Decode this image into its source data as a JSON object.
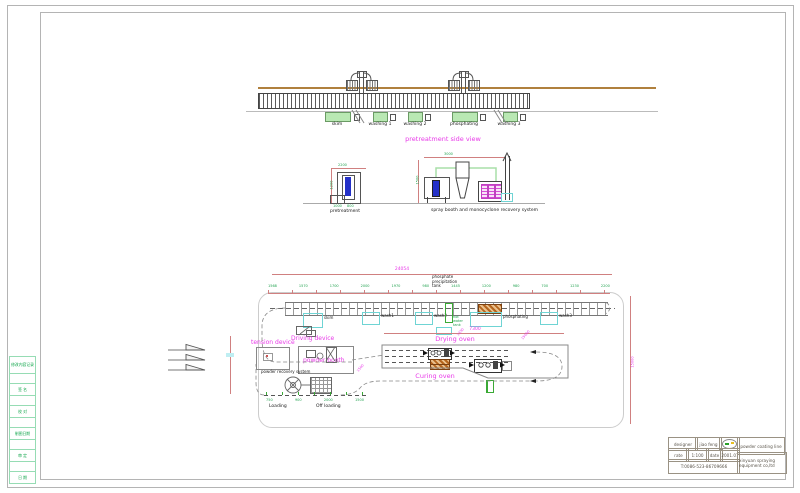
{
  "left_strip": {
    "cells": [
      "修改内容记录",
      "",
      "签 名",
      "",
      "校 对",
      "",
      "制图日期",
      "",
      "审 定",
      "",
      "日 期"
    ]
  },
  "side_view": {
    "title": "pretreatment side view",
    "tanks": [
      "skim",
      "washing 1",
      "washing 2",
      "phosphating",
      "washing 3"
    ]
  },
  "elevation": {
    "pretreatment_label": "pretreatment",
    "spray_label": "spray booth and monocyclone recovery system",
    "dims_green": [
      "2200",
      "1200",
      "3000",
      "1500",
      "1000",
      "800"
    ]
  },
  "plan": {
    "dim_total": "24054",
    "dim_row": [
      "1568",
      "1570",
      "1700",
      "2000",
      "1970",
      "980",
      "1445",
      "1200",
      "980",
      "700",
      "1230",
      "2200"
    ],
    "phosphate_tank": [
      "phosphate",
      "precipitation",
      "tank"
    ],
    "tanks": {
      "skim": "skim",
      "wash1": "wash1",
      "wash2": "wash2",
      "phosphating": "phosphating",
      "wash3": "wash3"
    },
    "hot_water": [
      "hot",
      "water",
      "tank"
    ],
    "labels": {
      "driving": "Driving device",
      "tension": "tension device",
      "powder_booth": "powder booth",
      "powder_recovery": "powder recovery system",
      "drying": "Drying oven",
      "curing": "Curing oven",
      "loading": "Loading",
      "off_loading": "Off loading"
    },
    "oven_dim": "7300",
    "bottom_dims": [
      "750",
      "900",
      "2000",
      "1500"
    ],
    "corner_dims": [
      "1500",
      "1330",
      "15000"
    ],
    "side_dim": "15000"
  },
  "title_block": {
    "designer_label": "designer",
    "designer_value": "jiao feng",
    "scale_label": "rate",
    "scale_value": "1:100",
    "date_label": "date",
    "date_value": "2001.07",
    "phone": "T:0086-523-86709666",
    "product": "powder coating line",
    "company": "xinyuan spraying equipment co,ltd"
  }
}
